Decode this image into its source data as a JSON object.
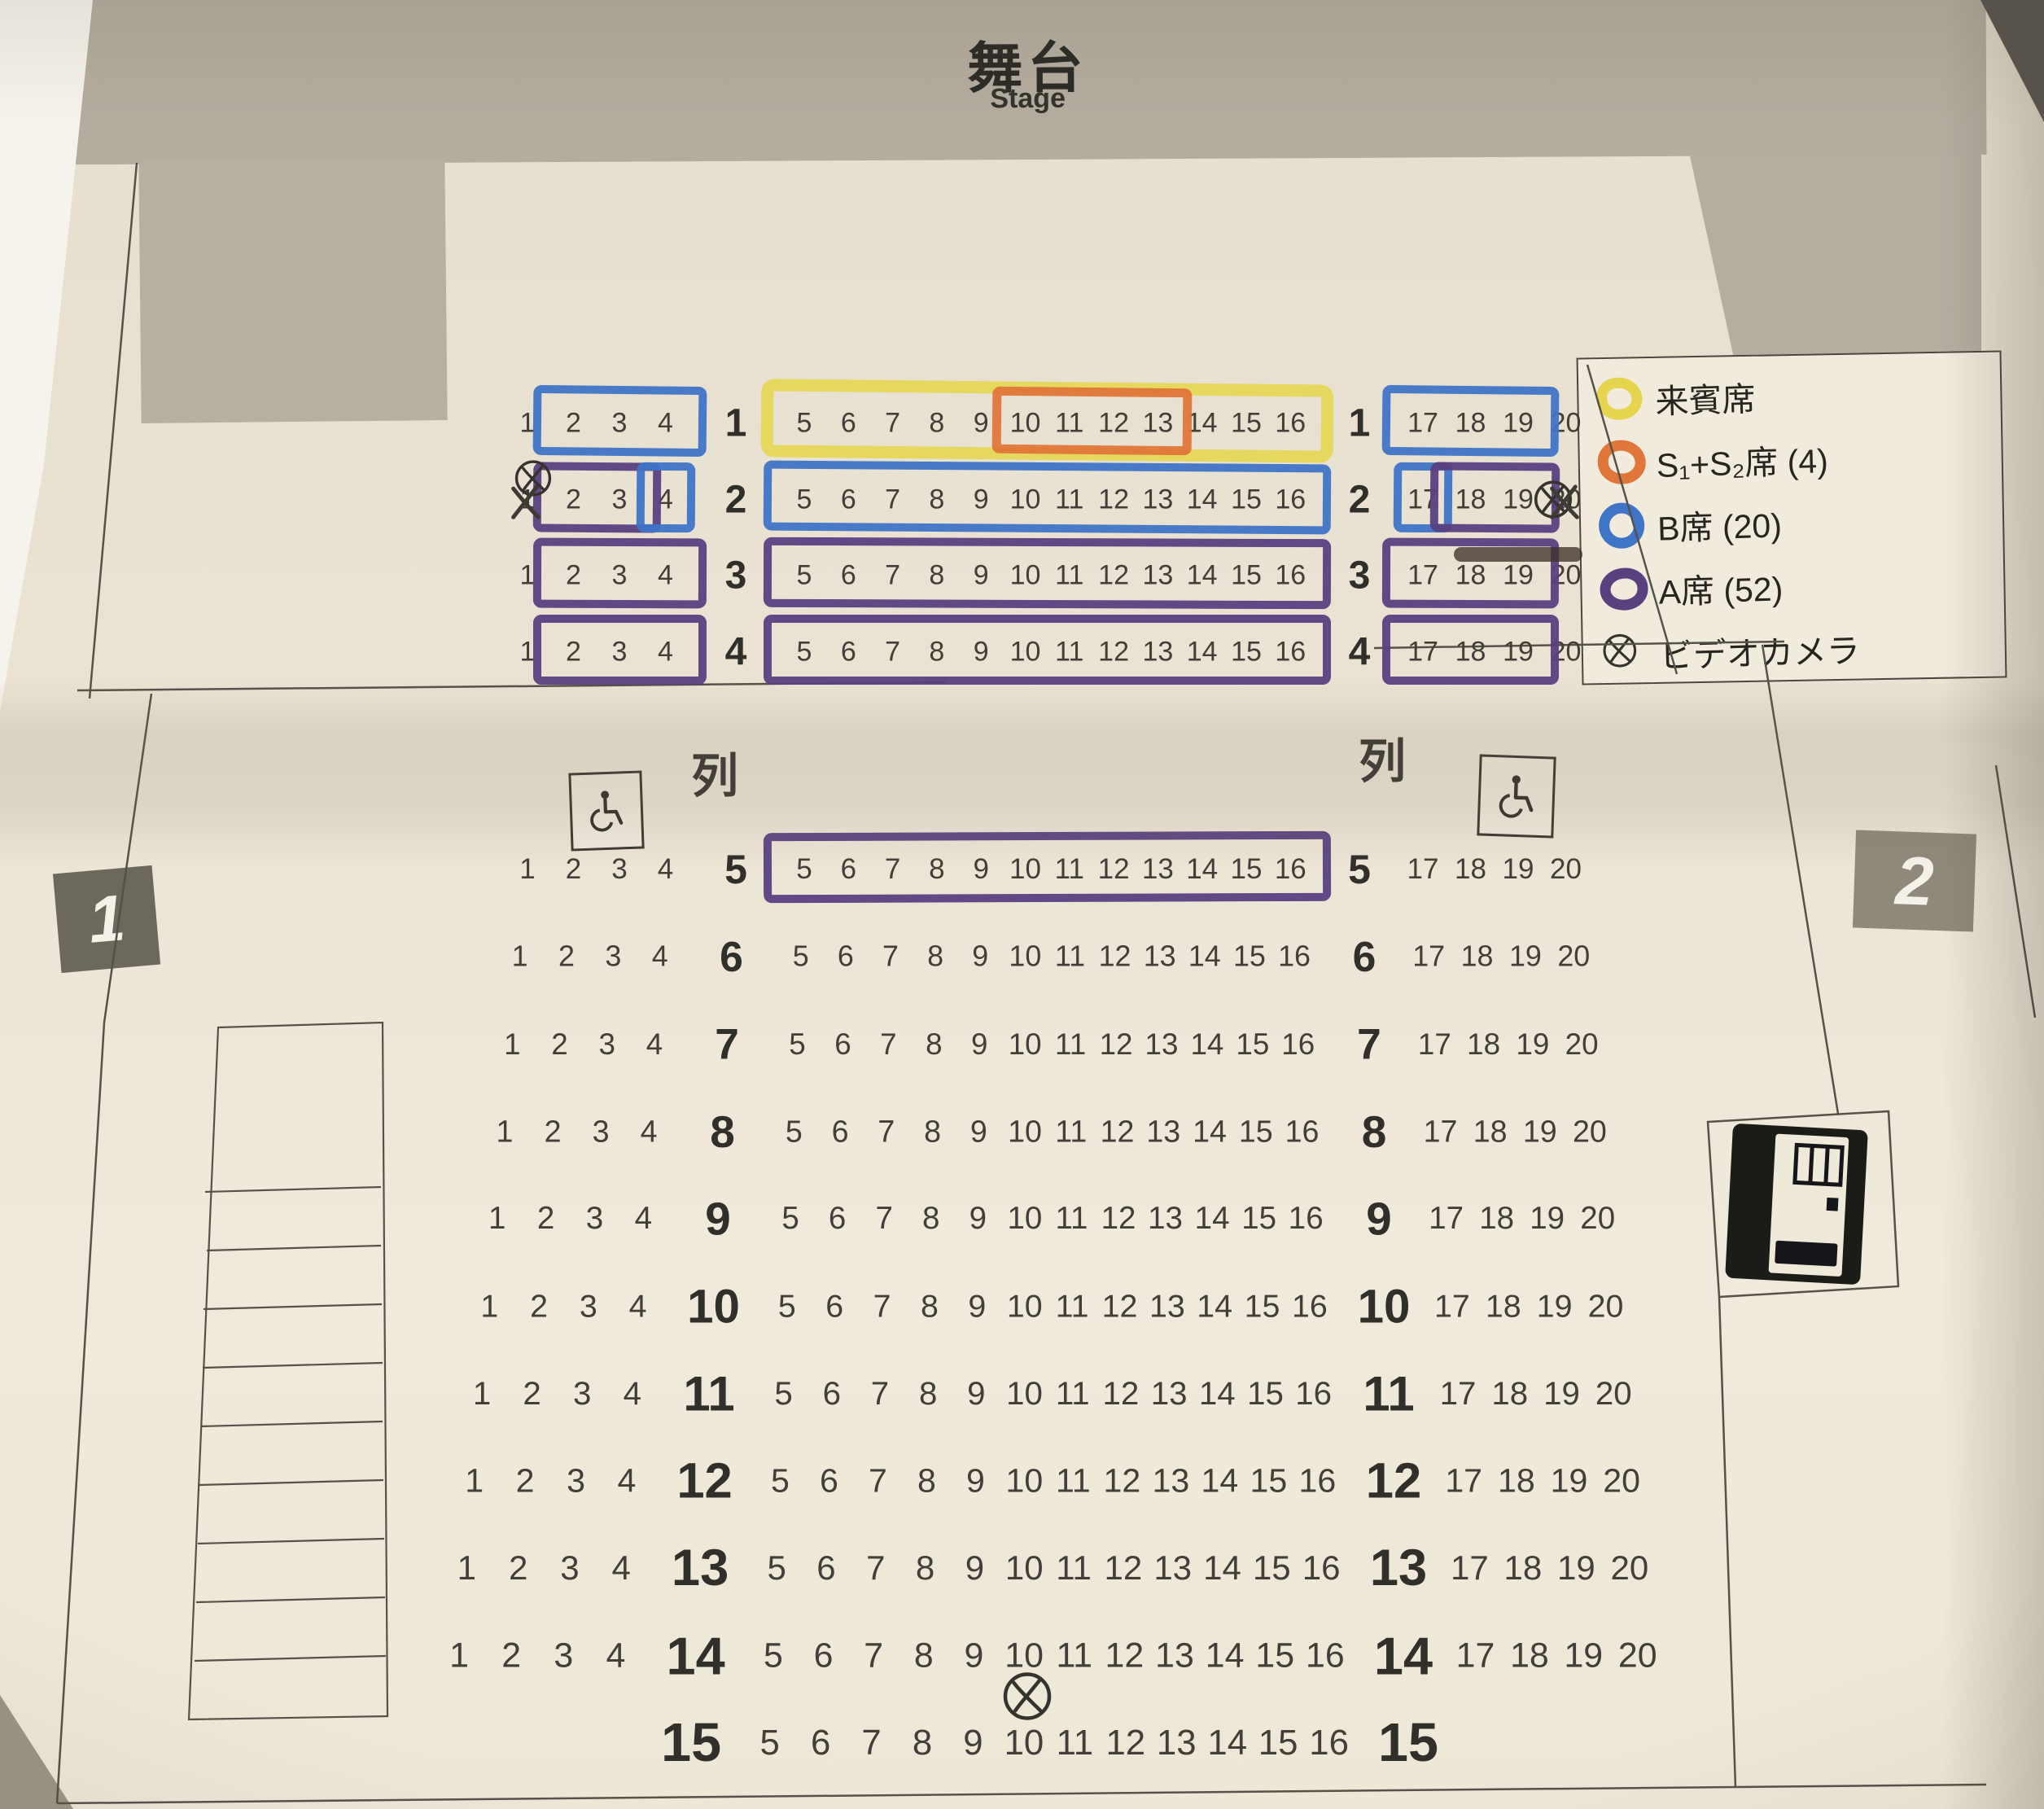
{
  "stage": {
    "title": "舞台",
    "subtitle": "Stage"
  },
  "legend": {
    "items": [
      {
        "id": "guest",
        "label": "来賓席",
        "symbol": "ring",
        "color": "guest_yellow"
      },
      {
        "id": "s1s2",
        "label": "S₁+S₂席 (4)",
        "symbol": "ring",
        "color": "s_orange"
      },
      {
        "id": "b",
        "label": "B席 (20)",
        "symbol": "ring",
        "color": "b_blue"
      },
      {
        "id": "a",
        "label": "A席 (52)",
        "symbol": "ring",
        "color": "a_purple"
      },
      {
        "id": "camera",
        "label": "ビデオカメラ",
        "symbol": "camera",
        "color": "ink"
      }
    ]
  },
  "colors": {
    "guest_yellow": "#e5d54e",
    "s_orange": "#e0763a",
    "b_blue": "#3f74c7",
    "a_purple": "#59407f",
    "ink": "#35332e"
  },
  "exits": [
    {
      "label": "1",
      "side": "left"
    },
    {
      "label": "2",
      "side": "right"
    }
  ],
  "seating": {
    "aisle_label": "列",
    "rows": [
      {
        "row": 1,
        "left": [
          1,
          4
        ],
        "center": [
          5,
          16
        ],
        "right": [
          17,
          20
        ]
      },
      {
        "row": 2,
        "left": [
          1,
          4
        ],
        "center": [
          5,
          16
        ],
        "right": [
          17,
          20
        ]
      },
      {
        "row": 3,
        "left": [
          1,
          4
        ],
        "center": [
          5,
          16
        ],
        "right": [
          17,
          20
        ]
      },
      {
        "row": 4,
        "left": [
          1,
          4
        ],
        "center": [
          5,
          16
        ],
        "right": [
          17,
          20
        ]
      },
      {
        "row": 5,
        "left": [
          1,
          4
        ],
        "center": [
          5,
          16
        ],
        "right": [
          17,
          20
        ]
      },
      {
        "row": 6,
        "left": [
          1,
          4
        ],
        "center": [
          5,
          16
        ],
        "right": [
          17,
          20
        ]
      },
      {
        "row": 7,
        "left": [
          1,
          4
        ],
        "center": [
          5,
          16
        ],
        "right": [
          17,
          20
        ]
      },
      {
        "row": 8,
        "left": [
          1,
          4
        ],
        "center": [
          5,
          16
        ],
        "right": [
          17,
          20
        ]
      },
      {
        "row": 9,
        "left": [
          1,
          4
        ],
        "center": [
          5,
          16
        ],
        "right": [
          17,
          20
        ]
      },
      {
        "row": 10,
        "left": [
          1,
          4
        ],
        "center": [
          5,
          16
        ],
        "right": [
          17,
          20
        ]
      },
      {
        "row": 11,
        "left": [
          1,
          4
        ],
        "center": [
          5,
          16
        ],
        "right": [
          17,
          20
        ]
      },
      {
        "row": 12,
        "left": [
          1,
          4
        ],
        "center": [
          5,
          16
        ],
        "right": [
          17,
          20
        ]
      },
      {
        "row": 13,
        "left": [
          1,
          4
        ],
        "center": [
          5,
          16
        ],
        "right": [
          17,
          20
        ]
      },
      {
        "row": 14,
        "left": [
          1,
          4
        ],
        "center": [
          5,
          16
        ],
        "right": [
          17,
          20
        ]
      },
      {
        "row": 15,
        "left": null,
        "center": [
          5,
          16
        ],
        "right": null
      }
    ],
    "seat_classes": [
      {
        "row": 1,
        "seats": [
          5,
          16
        ],
        "color": "guest_yellow",
        "style": "highlighter"
      },
      {
        "row": 1,
        "seats": [
          2,
          4
        ],
        "color": "b_blue",
        "style": "marker"
      },
      {
        "row": 1,
        "seats": [
          10,
          13
        ],
        "color": "s_orange",
        "style": "marker_small"
      },
      {
        "row": 1,
        "seats": [
          17,
          19
        ],
        "color": "b_blue",
        "style": "marker"
      },
      {
        "row": 2,
        "seats": [
          2,
          3
        ],
        "color": "a_purple",
        "style": "marker"
      },
      {
        "row": 2,
        "seats": [
          4,
          4
        ],
        "color": "b_blue",
        "style": "marker"
      },
      {
        "row": 2,
        "seats": [
          5,
          16
        ],
        "color": "b_blue",
        "style": "marker"
      },
      {
        "row": 2,
        "seats": [
          17,
          17
        ],
        "color": "b_blue",
        "style": "marker"
      },
      {
        "row": 2,
        "seats": [
          18,
          19
        ],
        "color": "a_purple",
        "style": "marker"
      },
      {
        "row": 3,
        "seats": [
          2,
          4
        ],
        "color": "a_purple",
        "style": "marker"
      },
      {
        "row": 3,
        "seats": [
          5,
          16
        ],
        "color": "a_purple",
        "style": "marker"
      },
      {
        "row": 3,
        "seats": [
          17,
          19
        ],
        "color": "a_purple",
        "style": "marker"
      },
      {
        "row": 4,
        "seats": [
          2,
          4
        ],
        "color": "a_purple",
        "style": "marker"
      },
      {
        "row": 4,
        "seats": [
          5,
          16
        ],
        "color": "a_purple",
        "style": "marker"
      },
      {
        "row": 4,
        "seats": [
          17,
          19
        ],
        "color": "a_purple",
        "style": "marker"
      },
      {
        "row": 5,
        "seats": [
          5,
          16
        ],
        "color": "a_purple",
        "style": "marker"
      }
    ],
    "crossed_out_seats": [
      {
        "row": 2,
        "seat": 1
      },
      {
        "row": 2,
        "seat": 20
      }
    ],
    "video_cameras": [
      {
        "location": "left-of-rows-1-2"
      },
      {
        "location": "right-of-rows-1-2"
      },
      {
        "location": "between-rows-14-15-seat-10"
      }
    ],
    "wheelchair_spots": [
      {
        "location": "left-aisle"
      },
      {
        "location": "right-aisle"
      }
    ]
  }
}
